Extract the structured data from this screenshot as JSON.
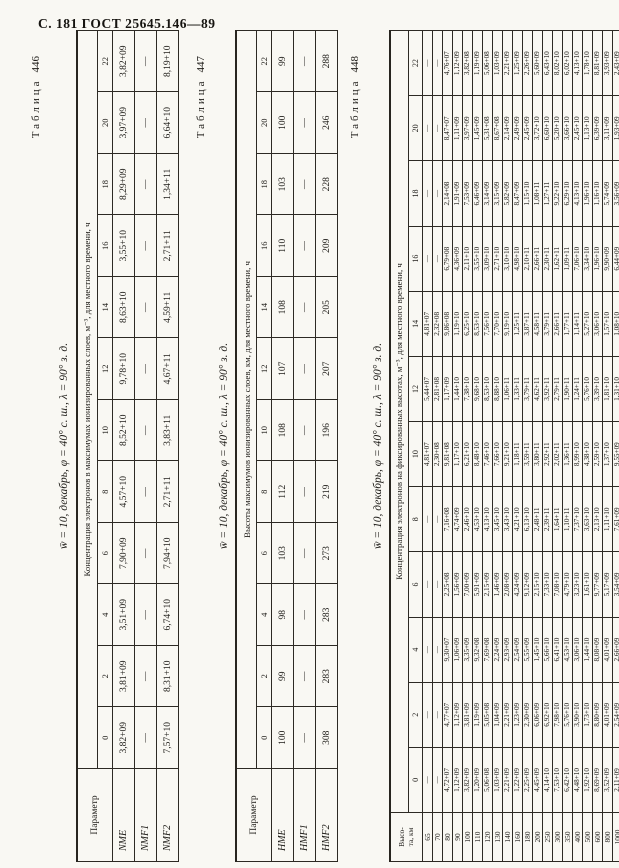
{
  "page": {
    "header": "С. 181 ГОСТ 25645.146—89"
  },
  "tables": [
    {
      "caption_word": "Таблица",
      "caption_num": "446",
      "condition": "w̄ = 10, декабрь, φ = 40° с. ш., λ = 90° з. д.",
      "param_header_lines": [
        "Параметр"
      ],
      "span_header": "Концентрация электронов в максимумах ионизированных слоев, м⁻³, для местного времени, ч",
      "time_cols": [
        "0",
        "2",
        "4",
        "6",
        "8",
        "10",
        "12",
        "14",
        "16",
        "18",
        "20",
        "22"
      ],
      "rows": [
        {
          "label": "NME",
          "values": [
            "3,82+09",
            "3,81+09",
            "3,51+09",
            "7,90+09",
            "4,57+10",
            "8,52+10",
            "9,78+10",
            "8,63+10",
            "3,55+10",
            "8,29+09",
            "3,97+09",
            "3,82+09"
          ]
        },
        {
          "label": "NMF1",
          "values": [
            "—",
            "—",
            "—",
            "—",
            "—",
            "—",
            "—",
            "—",
            "—",
            "—",
            "—",
            "—"
          ]
        },
        {
          "label": "NMF2",
          "values": [
            "7,57+10",
            "8,31+10",
            "6,74+10",
            "7,94+10",
            "2,71+11",
            "3,83+11",
            "4,67+11",
            "4,59+11",
            "2,71+11",
            "1,34+11",
            "6,64+10",
            "8,19+10"
          ]
        }
      ]
    },
    {
      "caption_word": "Таблица",
      "caption_num": "447",
      "condition": "w̄ = 10, декабрь, φ = 40° с. ш., λ = 90° з. д.",
      "param_header_lines": [
        "Параметр"
      ],
      "span_header": "Высоты максимумов ионизированных слоев, км, для местного времени, ч",
      "time_cols": [
        "0",
        "2",
        "4",
        "6",
        "8",
        "10",
        "12",
        "14",
        "16",
        "18",
        "20",
        "22"
      ],
      "rows": [
        {
          "label": "HME",
          "values": [
            "100",
            "99",
            "98",
            "103",
            "112",
            "108",
            "107",
            "108",
            "110",
            "103",
            "100",
            "99"
          ]
        },
        {
          "label": "HMF1",
          "values": [
            "—",
            "—",
            "—",
            "—",
            "—",
            "—",
            "—",
            "—",
            "—",
            "—",
            "—",
            "—"
          ]
        },
        {
          "label": "HMF2",
          "values": [
            "308",
            "283",
            "283",
            "273",
            "219",
            "196",
            "207",
            "205",
            "209",
            "228",
            "246",
            "288"
          ]
        }
      ]
    },
    {
      "caption_word": "Таблица",
      "caption_num": "448",
      "condition": "w̄ = 10, декабрь, φ = 40° с. ш., λ = 90° з. д.",
      "param_header_lines": [
        "Высо-",
        "та, км"
      ],
      "span_header": "Концентрация электронов на фиксированных высотах, м⁻³, для местного времени, ч",
      "time_cols": [
        "0",
        "2",
        "4",
        "6",
        "8",
        "10",
        "12",
        "14",
        "16",
        "18",
        "20",
        "22"
      ],
      "rows": [
        {
          "label": "65",
          "values": [
            "—",
            "—",
            "—",
            "—",
            "—",
            "4,81+07",
            "5,44+07",
            "4,81+07",
            "—",
            "—",
            "—",
            "—"
          ]
        },
        {
          "label": "70",
          "values": [
            "—",
            "—",
            "—",
            "—",
            "—",
            "2,30+08",
            "2,81+08",
            "2,32+08",
            "—",
            "—",
            "—",
            "—"
          ]
        },
        {
          "label": "80",
          "values": [
            "4,72+07",
            "4,77+07",
            "9,30+07",
            "2,25+08",
            "7,16+08",
            "9,81+08",
            "1,17+09",
            "9,86+08",
            "6,79+08",
            "2,14+08",
            "8,47+07",
            "4,76+07"
          ]
        },
        {
          "label": "90",
          "values": [
            "1,12+09",
            "1,12+09",
            "1,06+09",
            "1,56+09",
            "4,74+09",
            "1,17+10",
            "1,44+10",
            "1,19+10",
            "4,36+09",
            "1,91+09",
            "1,11+09",
            "1,12+09"
          ]
        },
        {
          "label": "100",
          "values": [
            "3,82+09",
            "3,81+09",
            "3,35+09",
            "7,00+09",
            "2,46+10",
            "6,21+10",
            "7,38+10",
            "6,25+10",
            "2,11+10",
            "7,53+09",
            "3,97+09",
            "3,82+08"
          ]
        },
        {
          "label": "110",
          "values": [
            "1,20+09",
            "1,19+09",
            "9,32+08",
            "5,91+09",
            "4,53+10",
            "8,48+10",
            "9,68+10",
            "8,53+10",
            "3,55+10",
            "6,46+09",
            "1,45+09",
            "1,19+09"
          ]
        },
        {
          "label": "120",
          "values": [
            "5,06+08",
            "5,05+08",
            "7,69+08",
            "2,15+09",
            "4,13+10",
            "7,46+10",
            "8,53+10",
            "7,56+10",
            "3,09+10",
            "3,14+09",
            "5,31+08",
            "5,06+08"
          ]
        },
        {
          "label": "130",
          "values": [
            "1,03+09",
            "1,04+09",
            "2,24+09",
            "1,46+09",
            "3,45+10",
            "7,66+10",
            "8,88+10",
            "7,70+10",
            "2,71+10",
            "3,15+09",
            "8,67+08",
            "1,03+09"
          ]
        },
        {
          "label": "140",
          "values": [
            "2,21+09",
            "2,21+09",
            "2,93+09",
            "2,08+09",
            "3,43+10",
            "9,21+10",
            "1,06+11",
            "9,19+10",
            "3,10+10",
            "5,82+09",
            "2,14+09",
            "2,21+09"
          ]
        },
        {
          "label": "160",
          "values": [
            "1,22+09",
            "1,23+09",
            "2,54+09",
            "4,24+09",
            "4,21+10",
            "1,18+11",
            "1,33+11",
            "1,25+11",
            "4,98+10",
            "8,47+09",
            "2,49+09",
            "1,25+09"
          ]
        },
        {
          "label": "180",
          "values": [
            "2,25+09",
            "2,30+09",
            "5,55+09",
            "9,12+09",
            "6,13+10",
            "3,59+11",
            "3,79+11",
            "3,87+11",
            "2,10+11",
            "1,15+10",
            "2,45+09",
            "2,26+09"
          ]
        },
        {
          "label": "200",
          "values": [
            "4,45+09",
            "6,06+09",
            "1,45+10",
            "2,15+10",
            "2,48+11",
            "3,80+11",
            "4,62+11",
            "4,58+11",
            "2,66+11",
            "1,08+11",
            "3,72+10",
            "5,60+09"
          ]
        },
        {
          "label": "250",
          "values": [
            "4,14+10",
            "6,92+10",
            "5,66+10",
            "7,33+10",
            "2,39+11",
            "2,92+11",
            "3,92+11",
            "3,79+11",
            "2,30+11",
            "1,27+11",
            "6,60+10",
            "6,43+10"
          ]
        },
        {
          "label": "300",
          "values": [
            "7,53+10",
            "7,98+10",
            "6,41+10",
            "7,08+10",
            "1,64+11",
            "2,02+11",
            "2,79+11",
            "2,66+11",
            "1,62+11",
            "9,22+10",
            "5,20+10",
            "8,02+10"
          ]
        },
        {
          "label": "350",
          "values": [
            "6,42+10",
            "5,76+10",
            "4,53+10",
            "4,79+10",
            "1,10+11",
            "1,36+11",
            "1,90+11",
            "1,77+11",
            "1,09+11",
            "6,29+10",
            "3,66+10",
            "6,02+10"
          ]
        },
        {
          "label": "400",
          "values": [
            "4,48+10",
            "3,90+10",
            "3,06+10",
            "3,23+10",
            "7,37+10",
            "8,99+10",
            "1,24+11",
            "1,14+11",
            "7,06+10",
            "4,13+10",
            "2,45+10",
            "4,13+10"
          ]
        },
        {
          "label": "500",
          "values": [
            "1,92+10",
            "1,73+10",
            "1,44+10",
            "1,61+10",
            "3,63+10",
            "4,38+10",
            "5,76+10",
            "5,27+10",
            "3,34+10",
            "1,96+10",
            "1,13+10",
            "1,78+10"
          ]
        },
        {
          "label": "600",
          "values": [
            "8,69+09",
            "8,80+09",
            "8,08+09",
            "9,77+09",
            "2,13+10",
            "2,59+10",
            "3,39+10",
            "3,06+10",
            "1,96+10",
            "1,16+10",
            "6,39+09",
            "8,81+09"
          ]
        },
        {
          "label": "800",
          "values": [
            "3,52+09",
            "4,01+09",
            "4,01+09",
            "5,17+09",
            "1,11+10",
            "1,37+10",
            "1,81+10",
            "1,57+10",
            "9,90+09",
            "5,74+09",
            "3,11+09",
            "3,93+09"
          ]
        },
        {
          "label": "1000",
          "values": [
            "2,11+09",
            "2,54+09",
            "2,66+09",
            "3,54+09",
            "7,61+09",
            "9,55+09",
            "1,31+10",
            "1,08+10",
            "6,44+09",
            "3,56+09",
            "1,93+09",
            "2,43+09"
          ]
        }
      ]
    }
  ]
}
